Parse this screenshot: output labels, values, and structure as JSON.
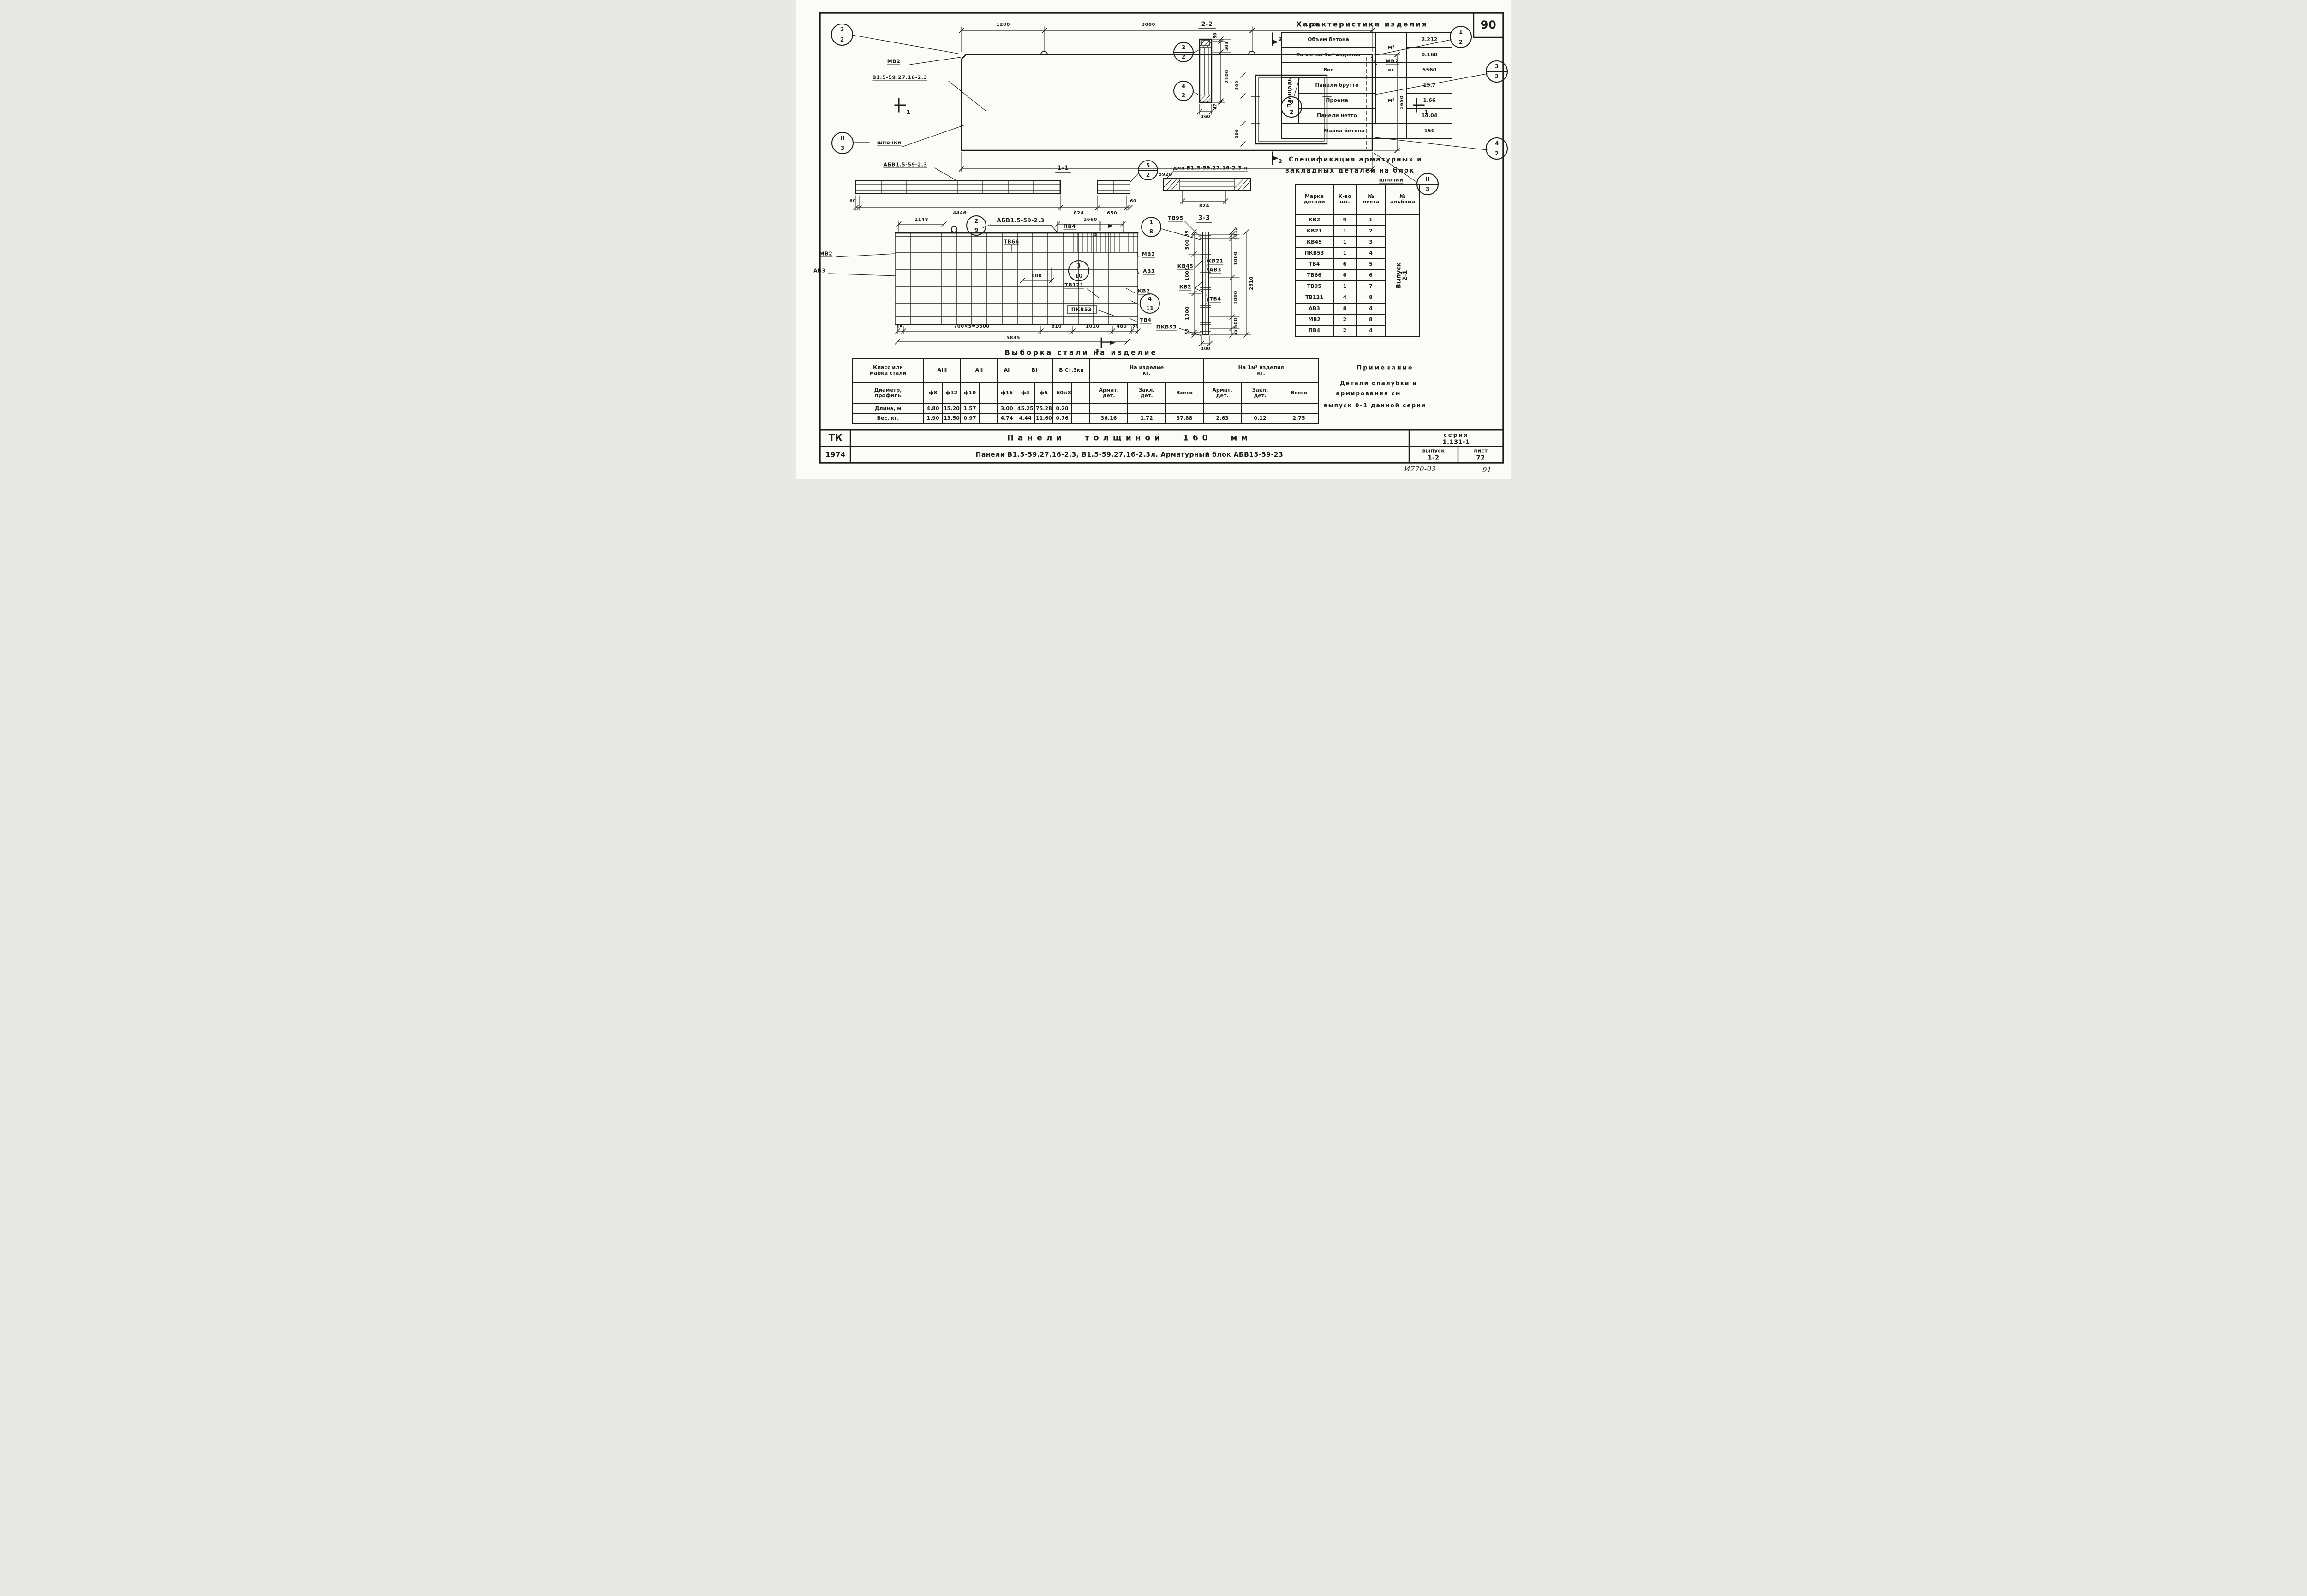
{
  "page": {
    "corner_number": "90",
    "doc_code": "И770-03",
    "sheet_code": "91"
  },
  "char_table": {
    "title": "Характеристика изделия",
    "group_label": "Площадь",
    "units": {
      "volume": "м³",
      "weight": "кг",
      "area": "м²"
    },
    "rows": [
      {
        "label": "Объем бетона",
        "value": "2.212"
      },
      {
        "label": "То же на 1м² изделия",
        "value": "0.160"
      },
      {
        "label": "Вес",
        "value": "5560"
      },
      {
        "label": "Панели брутто",
        "value": "15.7"
      },
      {
        "label": "Проема",
        "value": "1.66"
      },
      {
        "label": "Панели нетто",
        "value": "14.04"
      },
      {
        "label": "Марка бетона",
        "value": "150"
      }
    ]
  },
  "spec_table": {
    "title_line1": "Спецификация арматурных и",
    "title_line2": "закладных деталей на блок",
    "headers": {
      "mark_l1": "Марка",
      "mark_l2": "детали",
      "qty_l1": "К-во",
      "qty_l2": "шт.",
      "sheet_l1": "№",
      "sheet_l2": "листа",
      "album_l1": "№",
      "album_l2": "альбома"
    },
    "rows": [
      {
        "mark": "КВ2",
        "qty": "9",
        "sheet": "1"
      },
      {
        "mark": "КВ21",
        "qty": "1",
        "sheet": "2"
      },
      {
        "mark": "КВ45",
        "qty": "1",
        "sheet": "3"
      },
      {
        "mark": "ПКВ53",
        "qty": "1",
        "sheet": "4"
      },
      {
        "mark": "ТВ4",
        "qty": "6",
        "sheet": "5"
      },
      {
        "mark": "ТВ66",
        "qty": "6",
        "sheet": "6"
      },
      {
        "mark": "ТВ95",
        "qty": "1",
        "sheet": "7"
      },
      {
        "mark": "ТВ121",
        "qty": "4",
        "sheet": "8"
      },
      {
        "mark": "АВ3",
        "qty": "8",
        "sheet": "4"
      },
      {
        "mark": "МВ2",
        "qty": "2",
        "sheet": "8"
      },
      {
        "mark": "ПВ4",
        "qty": "2",
        "sheet": "4"
      }
    ],
    "album_line1": "Выпуск",
    "album_line2": "2-1"
  },
  "steel_table": {
    "title": "Выборка стали на изделие",
    "corner_l1": "Класс или",
    "corner_l2": "марка стали",
    "row_diameter_l1": "Диаметр,",
    "row_diameter_l2": "профиль",
    "row_length": "Длина, м",
    "row_weight": "Вес,    кг.",
    "groups": [
      "АIII",
      "АII",
      "АI",
      "ВI",
      "В Ст.3кп"
    ],
    "col_product": "На изделие",
    "col_product_unit": "кг.",
    "col_per_m2": "На 1м² изделия",
    "col_per_m2_unit": "кг.",
    "sub_arm_l1": "Армат.",
    "sub_arm_l2": "дет.",
    "sub_zakl_l1": "Закл.",
    "sub_zakl_l2": "дет.",
    "sub_total": "Всего",
    "diameters": [
      "ф8",
      "ф12",
      "ф10",
      "",
      "ф16",
      "ф4",
      "ф5",
      "-60×8",
      ""
    ],
    "lengths": [
      "4.80",
      "15.20",
      "1.57",
      "",
      "3.00",
      "45.25",
      "75.28",
      "0.20",
      ""
    ],
    "weights": [
      "1.90",
      "13.50",
      "0.97",
      "",
      "4.74",
      "4.44",
      "11.60",
      "0.76",
      ""
    ],
    "totals": {
      "prod_arm": "36.16",
      "prod_zakl": "1.72",
      "prod_total": "37.88",
      "m2_arm": "2.63",
      "m2_zakl": "0.12",
      "m2_total": "2.75"
    }
  },
  "note": {
    "title": "Примечание",
    "line1": "Детали опалубки и",
    "line2": "армирования см",
    "line3": "выпуск 0-1 данной серии"
  },
  "title_block": {
    "org": "ТК",
    "year": "1974",
    "row1_title": "Панели толщиной 160 мм",
    "row2_title": "Панели В1.5-59.27.16-2.3, В1.5-59.27.16-2.3л. Арматурный блок АБВ15-59-23",
    "series_label": "серия",
    "series_value": "1.131-1",
    "issue_label": "выпуск",
    "issue_value": "1-2",
    "sheet_label": "лист",
    "sheet_value": "72"
  },
  "plan": {
    "dim_1200": "1200",
    "dim_3000": "3000",
    "dim_1720": "1720",
    "dim_5920": "5920",
    "dim_2650": "2650",
    "dim_300_top": "300",
    "dim_300_bottom": "300",
    "label_mv2_left": "МВ2",
    "label_mv2_right": "МВ2",
    "label_panel": "В1.5-59.27.16-2.3",
    "label_shponki_left": "шпонки",
    "label_shponki_right": "шпонки",
    "callout_tl": {
      "top": "2",
      "bottom": "2"
    },
    "callout_tr": {
      "top": "1",
      "bottom": "2"
    },
    "callout_right_upper": {
      "top": "3",
      "bottom": "2"
    },
    "callout_right_lower": {
      "top": "4",
      "bottom": "2"
    },
    "callout_opening": {
      "top": "6",
      "bottom": "2"
    },
    "callout_key_left": {
      "top": "II",
      "bottom": "3"
    },
    "callout_key_right": {
      "top": "II",
      "bottom": "3"
    },
    "cut2": "2",
    "cut1": "1"
  },
  "section22": {
    "title": "2-2",
    "dim_50": "50",
    "dim_503": "503",
    "dim_2100": "2100",
    "dim_47": "47",
    "dim_160": "160",
    "callout_upper": {
      "top": "3",
      "bottom": "2"
    },
    "callout_lower": {
      "top": "4",
      "bottom": "2"
    }
  },
  "section11": {
    "title": "1-1",
    "label": "АБВ1.5-59-2.3",
    "dim_60_left": "60",
    "dim_4446": "4446",
    "dim_824": "824",
    "dim_650": "650",
    "dim_60_right": "60",
    "callout": {
      "top": "5",
      "bottom": "2"
    }
  },
  "detail_l": {
    "label": "для В1.5-59.27.16-2.3 л",
    "dim_824": "824"
  },
  "rebar": {
    "label_block": "АБВ1.5-59-2.3",
    "label_tv66": "ТВ66",
    "label_pv4": "ПВ4",
    "dim_1148": "1148",
    "dim_1660": "1660",
    "label_mv2_left": "МВ2",
    "label_av3_left": "АВ3",
    "label_mv2_right": "МВ2",
    "label_av3_right": "АВ3",
    "label_kv2": "КВ2",
    "label_tv4": "ТВ4",
    "label_tv121": "ТВ121",
    "label_pkv53": "ПКВ53",
    "dim_500": "500",
    "callout_hook": {
      "top": "2",
      "bottom": "9"
    },
    "callout_mid": {
      "top": "3",
      "bottom": "10"
    },
    "callout_right": {
      "top": "4",
      "bottom": "11"
    },
    "dim_15": "15",
    "dim_3500": "700×5=3500",
    "dim_810": "810",
    "dim_1010": "1010",
    "dim_480": "480",
    "dim_20": "20",
    "dim_5835": "5835",
    "cut3": "3"
  },
  "section33": {
    "title": "3-3",
    "label_tv95": "ТВ95",
    "callout": {
      "top": "1",
      "bottom": "8"
    },
    "label_kv45": "КВ45",
    "label_kv2": "КВ2",
    "label_kv21": "КВ21",
    "label_av3": "АВ3",
    "label_tv4": "ТВ4",
    "label_pkv53": "ПКВ53",
    "dims_left": [
      "55",
      "500",
      "1000",
      "1000",
      "55"
    ],
    "dims_right": [
      "15",
      "40",
      "1000",
      "1000",
      "500",
      "55"
    ],
    "dim_total": "2610",
    "dim_100": "100"
  }
}
